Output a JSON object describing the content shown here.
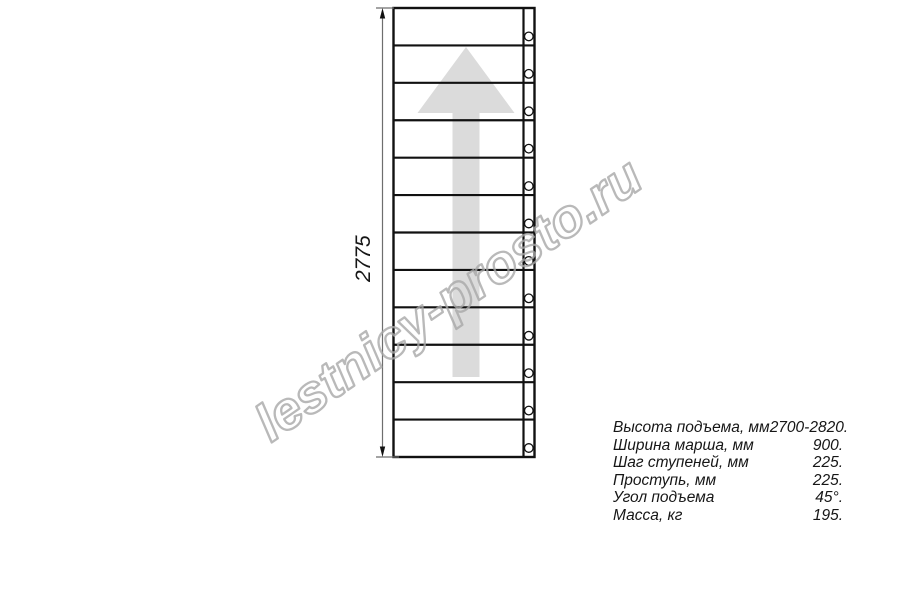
{
  "drawing": {
    "title_semantic": "staircase-flight-plan-view",
    "dimension_label": "2775",
    "steps_count": 12,
    "watermark_text": "lestnicy-prosto.ru",
    "colors": {
      "line": "#111111",
      "dimension_line": "#6e6e6e",
      "arrow_fill": "#dbdbdb",
      "watermark_stroke": "#a8a8a8",
      "text": "#161616"
    }
  },
  "specs": [
    {
      "label": "Высота подъема, мм",
      "value": "2700-2820."
    },
    {
      "label": "Ширина марша, мм",
      "value": "900."
    },
    {
      "label": "Шаг ступеней, мм",
      "value": "225."
    },
    {
      "label": "Проступь, мм",
      "value": "225."
    },
    {
      "label": "Угол подъема",
      "value": "45°."
    },
    {
      "label": "Масса, кг",
      "value": "195."
    }
  ]
}
